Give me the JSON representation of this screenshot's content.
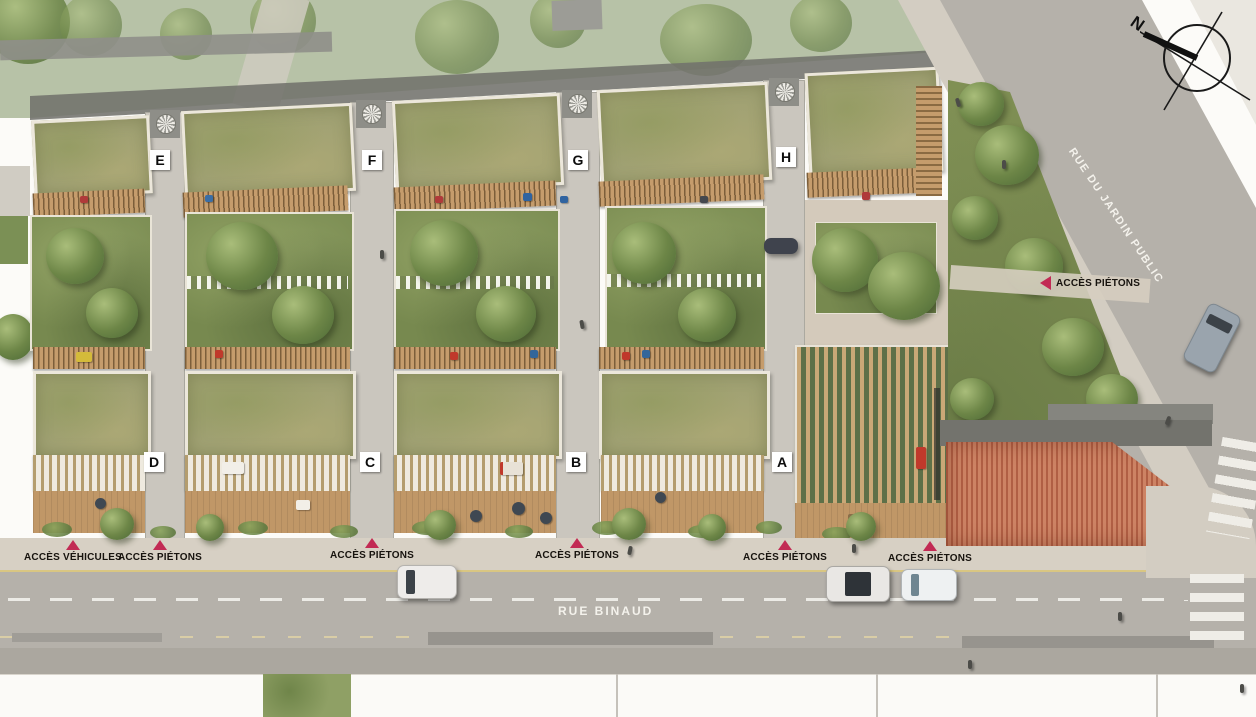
{
  "plan": {
    "compass": {
      "north_label": "N"
    },
    "streets": {
      "bottom": "RUE BINAUD",
      "right": "RUE DU JARDIN PUBLIC"
    },
    "buildings": [
      {
        "id": "E",
        "label": "E"
      },
      {
        "id": "F",
        "label": "F"
      },
      {
        "id": "G",
        "label": "G"
      },
      {
        "id": "H",
        "label": "H"
      },
      {
        "id": "D",
        "label": "D"
      },
      {
        "id": "C",
        "label": "C"
      },
      {
        "id": "B",
        "label": "B"
      },
      {
        "id": "A",
        "label": "A"
      }
    ],
    "access_points": [
      {
        "label": "ACCÈS VÉHICULES",
        "direction": "up"
      },
      {
        "label": "ACCÈS PIÉTONS",
        "direction": "up"
      },
      {
        "label": "ACCÈS PIÉTONS",
        "direction": "up"
      },
      {
        "label": "ACCÈS PIÉTONS",
        "direction": "up"
      },
      {
        "label": "ACCÈS PIÉTONS",
        "direction": "up"
      },
      {
        "label": "ACCÈS PIÉTONS",
        "direction": "up"
      },
      {
        "label": "ACCÈS PIÉTONS",
        "direction": "left"
      }
    ],
    "colors": {
      "accent_red": "#c22a54",
      "green_roof": "#a0a173",
      "garden_green": "#77894f",
      "wood_deck": "#c09767",
      "road_gray": "#b5b1aa",
      "sidewalk": "#d7d0c4",
      "tile_roof": "#cd8364"
    }
  }
}
